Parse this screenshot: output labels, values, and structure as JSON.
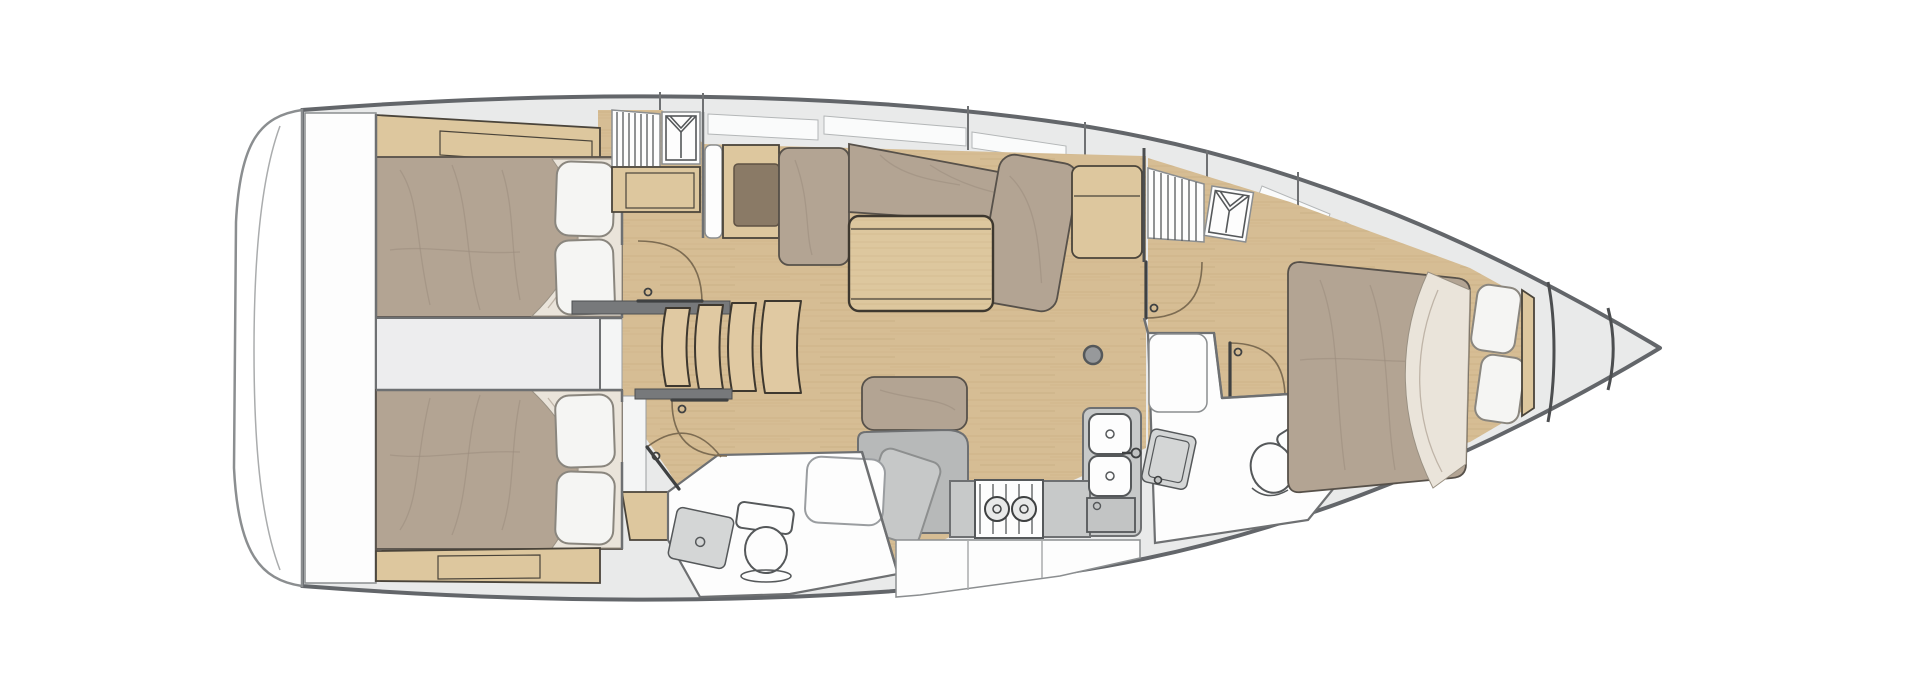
{
  "diagram": {
    "type": "yacht-interior-floor-plan",
    "orientation": "bow-right-top-down",
    "rooms": [
      {
        "id": "transom-platform",
        "furniture": [
          "swim-platform"
        ]
      },
      {
        "id": "aft-cabin-port",
        "furniture": [
          "double-berth",
          "pillow",
          "pillow",
          "shelf-locker",
          "cabin-door"
        ]
      },
      {
        "id": "aft-cabin-starboard",
        "furniture": [
          "double-berth",
          "pillow",
          "pillow",
          "shelf-locker",
          "cabin-door",
          "entry-step"
        ]
      },
      {
        "id": "engine-compartment",
        "furniture": []
      },
      {
        "id": "companionway",
        "furniture": [
          "step",
          "step",
          "step",
          "step",
          "threshold"
        ]
      },
      {
        "id": "saloon",
        "furniture": [
          "l-settee",
          "chaise-cushion",
          "corner-cushion",
          "folding-table",
          "storage-cabinet",
          "hanging-locker",
          "slatted-locker",
          "sideboard-with-worktop",
          "mast-post"
        ]
      },
      {
        "id": "nav-station",
        "furniture": [
          "seat-cushion",
          "chart-table"
        ]
      },
      {
        "id": "aft-head",
        "furniture": [
          "toilet",
          "sink-tray",
          "shower-tray",
          "bench",
          "door"
        ]
      },
      {
        "id": "galley",
        "furniture": [
          "two-burner-stove",
          "double-sink",
          "faucet",
          "top-loading-fridge",
          "l-counter",
          "cabinet-fronts"
        ]
      },
      {
        "id": "forward-head",
        "furniture": [
          "toilet",
          "vanity-sink",
          "counter",
          "door"
        ]
      },
      {
        "id": "forward-cabin",
        "furniture": [
          "island-berth",
          "pillow",
          "pillow",
          "headboard",
          "hanging-locker",
          "slatted-locker",
          "cabin-door"
        ]
      },
      {
        "id": "anchor-locker",
        "furniture": [
          "bow-bulkhead",
          "bow-bulkhead"
        ]
      }
    ],
    "icons": [
      "hanging-locker-icon",
      "hanging-locker-icon",
      "door-swing-arc",
      "mast-post-icon",
      "burner-icon",
      "drain-icon"
    ],
    "counts": {
      "cabins": 3,
      "heads": 2,
      "companionway_steps": 4,
      "doors": 5,
      "berths": 3
    }
  },
  "palette": {
    "hull-line": "#63666a",
    "deck": "#e9eaea",
    "wall": "#6e7072",
    "furn-line": "#4a443a",
    "wood-floor": "#d6bd94",
    "wood-furn": "#ddc79e",
    "quilt": "#b3a493",
    "pillow": "#f5f5f3",
    "sheet": "#eae4da",
    "counter": "#c7c9c9",
    "module": "#b7b9b9",
    "room-white": "#fdfdfd",
    "fixture": "#55585a",
    "arc": "#7d6c52",
    "panel-brown": "#8a7a66",
    "step-wood": "#e0c9a2"
  }
}
